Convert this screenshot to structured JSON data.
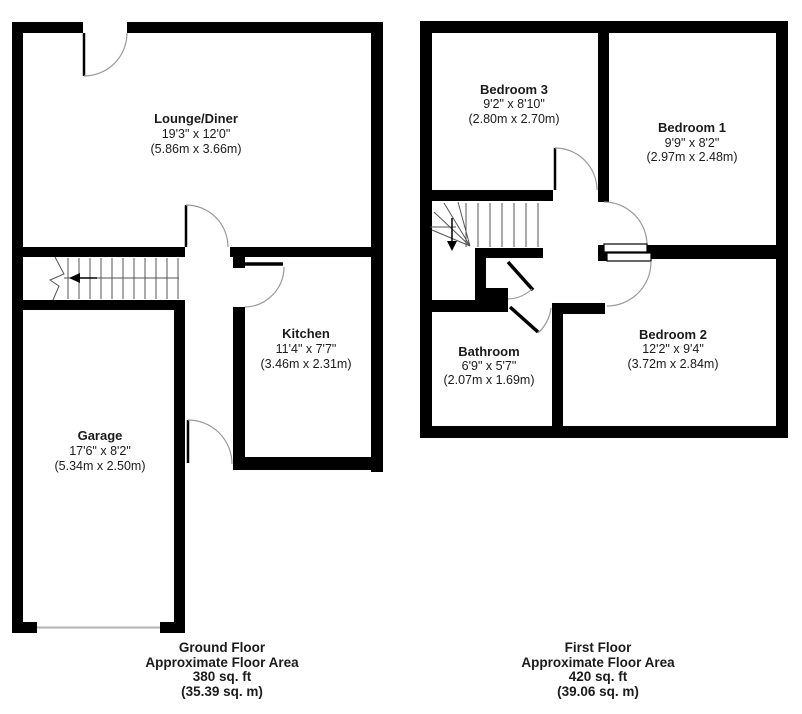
{
  "diagram_type": "residential-floor-plan",
  "colors": {
    "background": "#ffffff",
    "wall": "#000000",
    "door_arc": "#9a9a9a",
    "stair_line": "#555555",
    "garage_door_line": "#b3b3b3",
    "text": "#1b1b1b"
  },
  "ground_floor": {
    "rooms": [
      {
        "name": "Lounge/Diner",
        "imperial": "19'3\" x 12'0\"",
        "metric": "(5.86m x 3.66m)"
      },
      {
        "name": "Kitchen",
        "imperial": "11'4\" x 7'7\"",
        "metric": "(3.46m x 2.31m)"
      },
      {
        "name": "Garage",
        "imperial": "17'6\" x 8'2\"",
        "metric": "(5.34m x 2.50m)"
      }
    ],
    "stairs_direction": "left",
    "footer": {
      "line1": "Ground Floor",
      "line2": "Approximate Floor Area",
      "line3": "380 sq. ft",
      "line4": "(35.39 sq. m)"
    }
  },
  "first_floor": {
    "rooms": [
      {
        "name": "Bedroom 3",
        "imperial": "9'2\" x 8'10\"",
        "metric": "(2.80m x 2.70m)"
      },
      {
        "name": "Bedroom 1",
        "imperial": "9'9\" x 8'2\"",
        "metric": "(2.97m x 2.48m)"
      },
      {
        "name": "Bedroom 2",
        "imperial": "12'2\" x 9'4\"",
        "metric": "(3.72m x 2.84m)"
      },
      {
        "name": "Bathroom",
        "imperial": "6'9\" x 5'7\"",
        "metric": "(2.07m x 1.69m)"
      }
    ],
    "stairs_direction": "down",
    "footer": {
      "line1": "First Floor",
      "line2": "Approximate Floor Area",
      "line3": "420 sq. ft",
      "line4": "(39.06 sq. m)"
    }
  }
}
